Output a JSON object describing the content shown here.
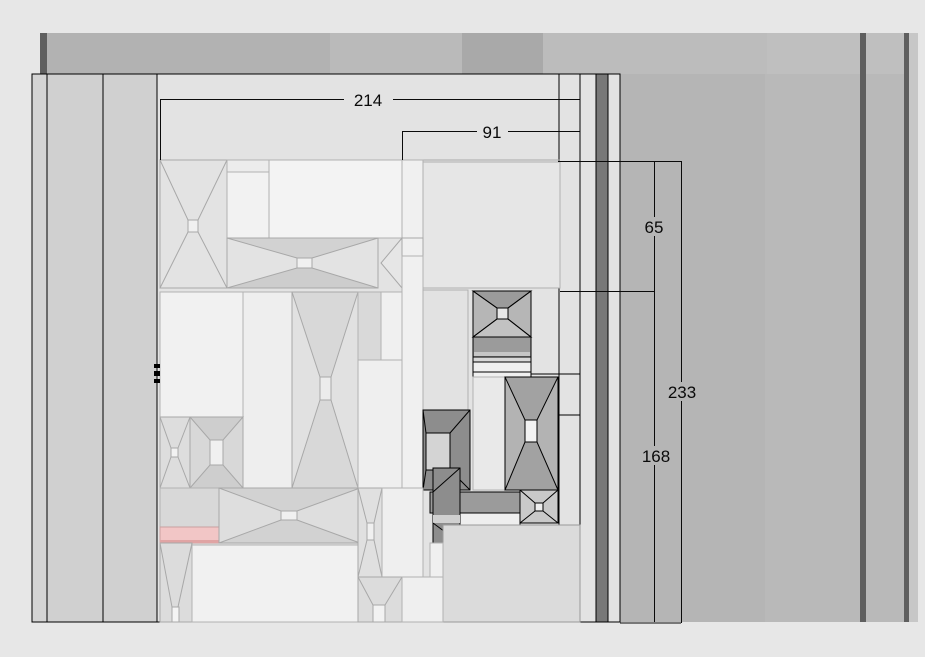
{
  "view": {
    "title": "panel-elevation-drawing"
  },
  "dimensions": [
    {
      "id": "total-width",
      "label": "214",
      "orientation": "horizontal"
    },
    {
      "id": "partial-width",
      "label": "91",
      "orientation": "horizontal"
    },
    {
      "id": "upper-height",
      "label": "65",
      "orientation": "vertical"
    },
    {
      "id": "total-height",
      "label": "233",
      "orientation": "vertical"
    },
    {
      "id": "lower-height",
      "label": "168",
      "orientation": "vertical"
    }
  ],
  "colors": {
    "canvas_bg": "#e7e7e7",
    "backdrop_gray": "#b5b5b5",
    "backdrop_gray_light": "#bcbcbc",
    "backdrop_gray_dark": "#a9a9a9",
    "panel_bg": "#e3e3e3",
    "stud_gray": "#d2d2d2",
    "dark_stripe": "#5f5f5f",
    "wall_stripe": "#787878",
    "highlight_pink": "#f2c6c6",
    "highlight_pink_edge": "#e0a4a4",
    "dark_piece": "#8d8d8d",
    "dimension_text": "#0a0a0a"
  }
}
